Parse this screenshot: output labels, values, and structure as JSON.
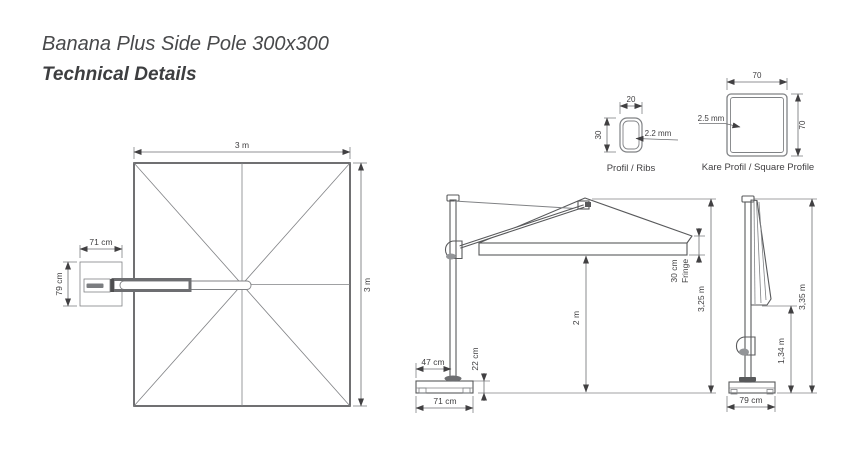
{
  "page": {
    "title": "Banana Plus Side Pole 300x300",
    "subtitle": "Technical Details"
  },
  "colors": {
    "drawing_line": "#58595b",
    "dimension_line": "#6d6e71",
    "text": "#414042",
    "background": "#ffffff"
  },
  "top_view": {
    "width_label": "3 m",
    "height_label": "3 m",
    "base_width_label": "71 cm",
    "base_height_label": "79 cm"
  },
  "side_view": {
    "pole_offset_label": "47 cm",
    "base_height_label": "22 cm",
    "base_width_label": "71 cm",
    "clearance_label": "2 m",
    "fringe_value_label": "30 cm",
    "fringe_word_label": "Fringe",
    "total_height_label": "3,25 m"
  },
  "closed_view": {
    "canopy_bottom_height_label": "1,34 m",
    "total_height_label": "3,35 m",
    "base_width_label": "79 cm"
  },
  "rib_profile": {
    "width_label": "20",
    "height_label": "30",
    "thickness_label": "2.2 mm",
    "caption": "Profil / Ribs"
  },
  "square_profile": {
    "width_label": "70",
    "height_label": "70",
    "thickness_label": "2.5 mm",
    "caption": "Kare Profil / Square Profile"
  }
}
